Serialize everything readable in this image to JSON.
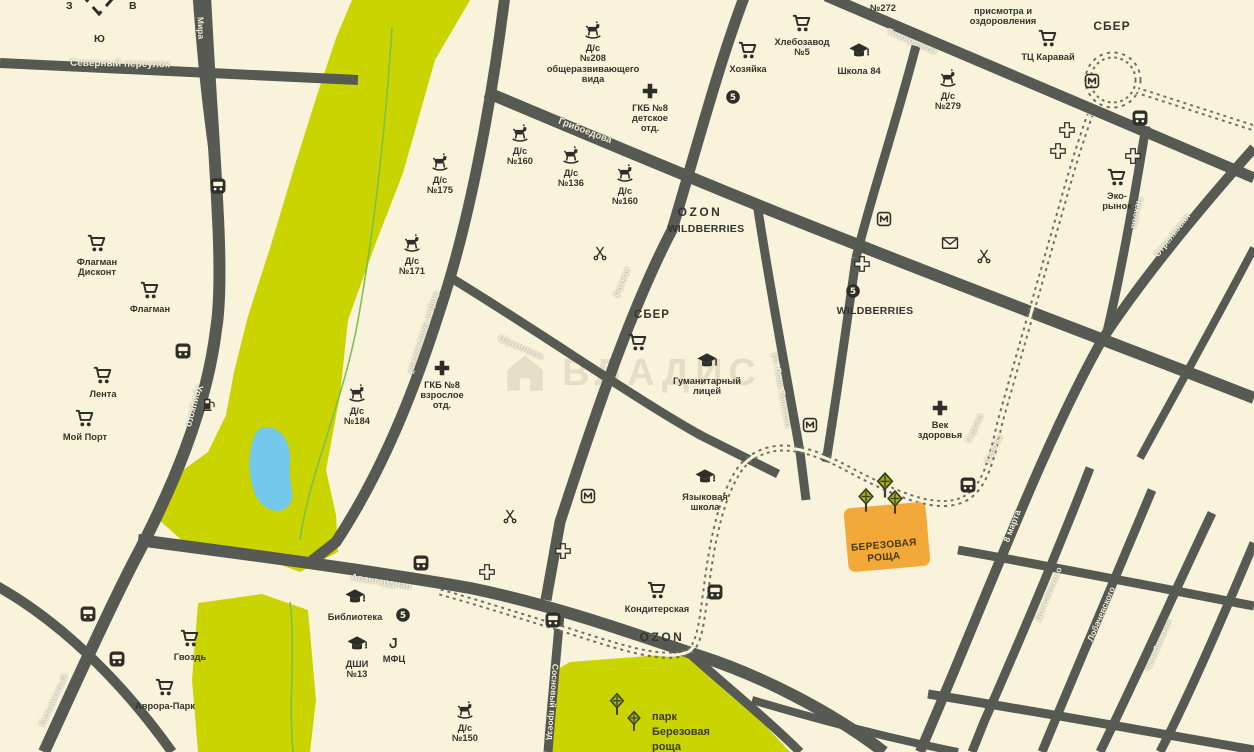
{
  "colors": {
    "bg": "#faf3dc",
    "road": "#575a52",
    "park": "#c9d400",
    "water": "#74c8ec",
    "stream": "#7fbf4d",
    "orange": "#f3a93a",
    "icon": "#2e2d27",
    "label": "#35342c",
    "street_text": "#f2eedd",
    "tree": "#9ab520"
  },
  "compass": {
    "west": "З",
    "east": "В",
    "south": "Ю"
  },
  "watermark": {
    "text": "ВЛАДИС"
  },
  "highlight": {
    "line1": "БЕРЕЗОВАЯ",
    "line2": "РОЩА"
  },
  "park_label": {
    "line1": "парк",
    "line2": "Березовая",
    "line3": "роща"
  },
  "streets": [
    {
      "n": "Северный переулок",
      "x": 120,
      "y": 64,
      "r": 1,
      "s": 10
    },
    {
      "n": "Мира",
      "x": 201,
      "y": 28,
      "r": 88,
      "s": 8.5
    },
    {
      "n": "Урицкого",
      "x": 194,
      "y": 406,
      "r": 105,
      "s": 9.5
    },
    {
      "n": "Грибоедова",
      "x": 585,
      "y": 131,
      "r": 21,
      "s": 9.5
    },
    {
      "n": "Софьи Ковалевской",
      "x": 424,
      "y": 333,
      "r": 108,
      "s": 8.5
    },
    {
      "n": "Шумилова",
      "x": 521,
      "y": 347,
      "r": 24,
      "s": 9
    },
    {
      "n": "Ротная",
      "x": 622,
      "y": 282,
      "r": -69,
      "s": 9
    },
    {
      "n": "ул. Льва Толстого",
      "x": 782,
      "y": 390,
      "r": 80,
      "s": 8.5
    },
    {
      "n": "Авангардная",
      "x": 381,
      "y": 582,
      "r": 9,
      "s": 9.5
    },
    {
      "n": "Сосновый проезд",
      "x": 553,
      "y": 702,
      "r": 94,
      "s": 8.5
    },
    {
      "n": "Серова",
      "x": 974,
      "y": 428,
      "r": -65,
      "s": 8.5
    },
    {
      "n": "Серова",
      "x": 993,
      "y": 449,
      "r": -65,
      "s": 8.5
    },
    {
      "n": "8 марта",
      "x": 1012,
      "y": 526,
      "r": -69,
      "s": 9
    },
    {
      "n": "Тимирязева",
      "x": 912,
      "y": 41,
      "r": 23,
      "s": 9
    },
    {
      "n": "Чехова",
      "x": 1137,
      "y": 213,
      "r": 101,
      "s": 9
    },
    {
      "n": "Стрелковая",
      "x": 1172,
      "y": 235,
      "r": -52,
      "s": 9
    },
    {
      "n": "Достоевского",
      "x": 1048,
      "y": 594,
      "r": -67,
      "s": 8.5
    },
    {
      "n": "Лобачевского",
      "x": 1101,
      "y": 614,
      "r": -67,
      "s": 8.5
    },
    {
      "n": "Челябинская",
      "x": 1158,
      "y": 645,
      "r": -67,
      "s": 8.5
    },
    {
      "n": "Безымянный",
      "x": 53,
      "y": 700,
      "r": -65,
      "s": 8.5
    }
  ],
  "pois": [
    {
      "t": "cart",
      "x": 97,
      "y": 243,
      "l": "Флагман\nДисконт"
    },
    {
      "t": "cart",
      "x": 150,
      "y": 290,
      "l": "Флагман"
    },
    {
      "t": "cart",
      "x": 103,
      "y": 375,
      "l": "Лента"
    },
    {
      "t": "cart",
      "x": 85,
      "y": 418,
      "l": "Мой Порт"
    },
    {
      "t": "cart",
      "x": 190,
      "y": 638,
      "l": "Гвоздь"
    },
    {
      "t": "cart",
      "x": 165,
      "y": 687,
      "l": "Аврора-Парк"
    },
    {
      "t": "cart",
      "x": 748,
      "y": 50,
      "l": "Хозяйка"
    },
    {
      "t": "cart",
      "x": 802,
      "y": 23,
      "l": "Хлебозавод\n№5"
    },
    {
      "t": "cart",
      "x": 1048,
      "y": 38,
      "l": "ТЦ Каравай"
    },
    {
      "t": "cart",
      "x": 638,
      "y": 342
    },
    {
      "t": "cart",
      "x": 657,
      "y": 590,
      "l": "Кондитерская"
    },
    {
      "t": "cart",
      "x": 1117,
      "y": 177,
      "l": "Эко-\nрынок"
    },
    {
      "t": "grad",
      "x": 859,
      "y": 52,
      "l": "Школа 84"
    },
    {
      "t": "grad",
      "x": 707,
      "y": 362,
      "l": "Гуманитарный\nлицей"
    },
    {
      "t": "grad",
      "x": 705,
      "y": 478,
      "l": "Языковая\nшкола"
    },
    {
      "t": "grad",
      "x": 355,
      "y": 598,
      "l": "Библиотека"
    },
    {
      "t": "grad",
      "x": 357,
      "y": 645,
      "l": "ДШИ\n№13"
    },
    {
      "t": "horse",
      "x": 593,
      "y": 30,
      "l": "Д/с\n№208\nобщеразвивающего\nвида"
    },
    {
      "t": "horse",
      "x": 440,
      "y": 162,
      "l": "Д/с\n№175"
    },
    {
      "t": "horse",
      "x": 412,
      "y": 243,
      "l": "Д/с\n№171"
    },
    {
      "t": "horse",
      "x": 357,
      "y": 393,
      "l": "Д/с\n№184"
    },
    {
      "t": "horse",
      "x": 520,
      "y": 133,
      "l": "Д/с\n№160"
    },
    {
      "t": "horse",
      "x": 571,
      "y": 155,
      "l": "Д/с\n№136"
    },
    {
      "t": "horse",
      "x": 625,
      "y": 173,
      "l": "Д/с\n№160"
    },
    {
      "t": "horse",
      "x": 948,
      "y": 78,
      "l": "Д/с\n№279"
    },
    {
      "t": "horse",
      "x": 883,
      "y": -10,
      "l": "№272"
    },
    {
      "t": "horse",
      "x": 465,
      "y": 710,
      "l": "Д/с\n№150"
    },
    {
      "t": "text",
      "x": 1003,
      "y": 16,
      "l": "присмотра и\nоздоровления",
      "s": 9.3
    },
    {
      "t": "cross",
      "x": 650,
      "y": 91,
      "l": "ГКБ №8\nдетское\nотд."
    },
    {
      "t": "cross",
      "x": 442,
      "y": 368,
      "l": "ГКБ №8\nвзрослое\nотд."
    },
    {
      "t": "cross",
      "x": 940,
      "y": 408,
      "l": "Век\nздоровья"
    },
    {
      "t": "crossO",
      "x": 1067,
      "y": 130
    },
    {
      "t": "crossO",
      "x": 1058,
      "y": 151
    },
    {
      "t": "crossO",
      "x": 1133,
      "y": 156
    },
    {
      "t": "crossO",
      "x": 862,
      "y": 264
    },
    {
      "t": "crossO",
      "x": 563,
      "y": 551
    },
    {
      "t": "crossO",
      "x": 487,
      "y": 572
    },
    {
      "t": "m",
      "x": 884,
      "y": 219
    },
    {
      "t": "m",
      "x": 1092,
      "y": 81
    },
    {
      "t": "m",
      "x": 588,
      "y": 496
    },
    {
      "t": "m",
      "x": 810,
      "y": 425
    },
    {
      "t": "five",
      "x": 733,
      "y": 97
    },
    {
      "t": "five",
      "x": 853,
      "y": 291
    },
    {
      "t": "five",
      "x": 403,
      "y": 615
    },
    {
      "t": "envelope",
      "x": 950,
      "y": 243
    },
    {
      "t": "scissors",
      "x": 600,
      "y": 253
    },
    {
      "t": "scissors",
      "x": 510,
      "y": 516
    },
    {
      "t": "scissors",
      "x": 984,
      "y": 256
    },
    {
      "t": "bus",
      "x": 218,
      "y": 186
    },
    {
      "t": "bus",
      "x": 183,
      "y": 351
    },
    {
      "t": "bus",
      "x": 88,
      "y": 614
    },
    {
      "t": "bus",
      "x": 117,
      "y": 659
    },
    {
      "t": "bus",
      "x": 421,
      "y": 563
    },
    {
      "t": "bus",
      "x": 553,
      "y": 620
    },
    {
      "t": "bus",
      "x": 715,
      "y": 592
    },
    {
      "t": "bus",
      "x": 968,
      "y": 485
    },
    {
      "t": "bus",
      "x": 1140,
      "y": 118
    },
    {
      "t": "fuel",
      "x": 209,
      "y": 404
    },
    {
      "t": "mfc",
      "x": 394,
      "y": 644,
      "l": "МФЦ"
    },
    {
      "t": "text",
      "x": 700,
      "y": 212,
      "l": "OZON",
      "s": 12,
      "ls": 2.5
    },
    {
      "t": "text",
      "x": 706,
      "y": 229,
      "l": "WILDBERRIES",
      "s": 10.5,
      "ls": 0.3
    },
    {
      "t": "text",
      "x": 875,
      "y": 311,
      "l": "WILDBERRIES",
      "s": 10.5,
      "ls": 0.3
    },
    {
      "t": "text",
      "x": 1112,
      "y": 26,
      "l": "СБЕР",
      "s": 12,
      "ls": 1
    },
    {
      "t": "text",
      "x": 652,
      "y": 315,
      "l": "СБЕР",
      "s": 11.5,
      "ls": 1
    },
    {
      "t": "text",
      "x": 662,
      "y": 637,
      "l": "OZON",
      "s": 12,
      "ls": 2.5
    }
  ]
}
